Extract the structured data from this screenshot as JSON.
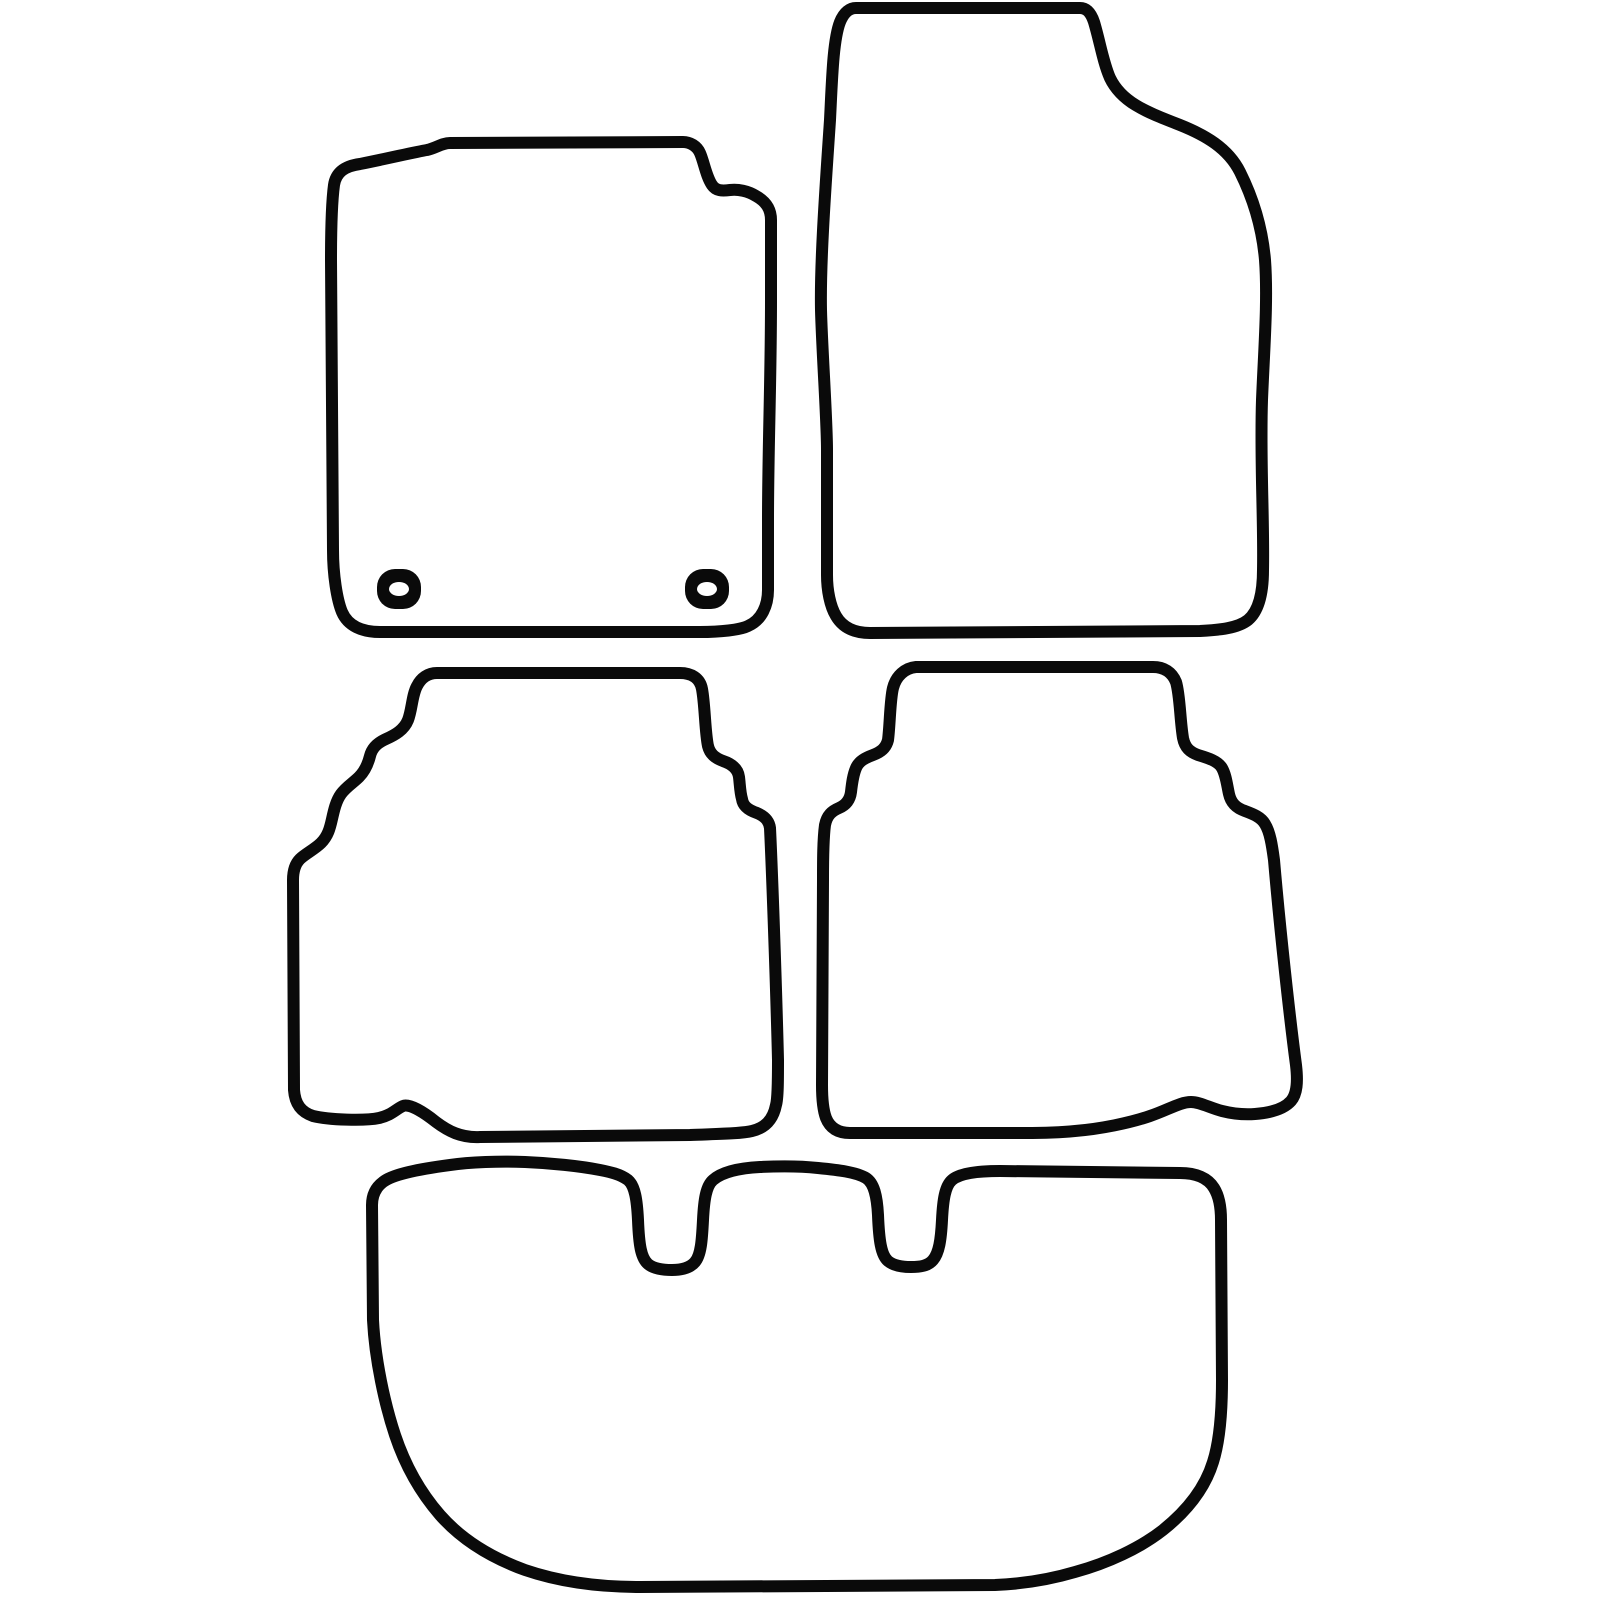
{
  "canvas": {
    "width": 1600,
    "height": 1600,
    "background_color": "#ffffff",
    "outline_color": "#0a0a0a",
    "outline_width": 12
  },
  "illustration": {
    "kind": "car-floor-mat-set-outline",
    "piece_count": 5
  },
  "mats": [
    {
      "id": "front-left-mat",
      "label": "front left mat",
      "d": "M 450,143 L 683,142 C 690,142 697,146 700,153 C 704,162 706,176 712,185 C 716,191 722,191 730,190 C 738,189 748,191 756,196 C 765,201 771,208 771,220 L 771,300 C 771,380 768,450 768,520 L 768,590 C 768,605 762,620 748,626 C 740,630 720,632 700,632 L 380,632 C 362,632 348,626 342,612 C 337,600 333,575 333,550 L 331,260 C 331,230 332,200 334,185 C 336,172 345,166 360,164 C 390,158 415,152 427,150 C 436,148 442,143 450,143 Z"
    },
    {
      "id": "front-right-mat",
      "label": "front right mat",
      "d": "M 856,8 L 1080,8 C 1087,8 1091,13 1094,22 C 1100,42 1103,62 1110,78 C 1122,103 1147,112 1180,125 C 1205,135 1228,148 1240,172 C 1252,196 1262,225 1265,260 C 1268,300 1264,350 1262,400 C 1260,460 1264,520 1263,570 C 1263,590 1260,610 1248,620 C 1238,628 1220,630 1200,631 L 870,633 C 855,633 843,628 836,616 C 830,606 827,590 827,575 L 827,450 C 827,420 822,350 821,310 C 820,260 826,180 830,120 C 832,80 833,40 840,22 C 844,12 850,8 856,8 Z"
    },
    {
      "id": "rear-left-mat",
      "label": "rear left mat",
      "d": "M 437,673 L 680,673 C 691,673 700,678 702,689 C 705,705 705,732 708,746 C 710,754 715,758 723,761 C 732,764 738,769 739,777 C 740,785 740,792 742,799 C 743,806 748,810 757,813 C 764,816 769,820 770,828 C 772,870 776,980 778,1060 C 778,1080 778,1098 776,1105 C 773,1120 765,1128 752,1131 C 740,1134 710,1134 690,1135 L 480,1137 C 461,1138 448,1131 436,1122 C 426,1114 410,1103 403,1106 C 396,1109 392,1115 379,1118 C 365,1121 329,1120 313,1116 C 301,1112 295,1104 294,1090 L 293,880 C 293,871 295,864 300,859 C 305,854 315,849 321,843 C 328,836 330,828 332,819 C 334,810 336,801 341,794 C 346,787 353,783 359,777 C 365,771 368,764 370,756 C 372,748 377,743 386,739 C 395,735 404,730 408,720 C 412,710 412,695 417,686 C 421,678 428,673 437,673 Z"
    },
    {
      "id": "rear-right-mat",
      "label": "rear right mat",
      "d": "M 930,667 L 1153,667 C 1164,667 1172,672 1176,682 C 1180,695 1180,720 1183,738 C 1185,748 1190,752 1198,755 C 1208,758 1218,761 1222,768 C 1226,775 1227,785 1229,794 C 1231,803 1236,808 1245,811 C 1253,814 1261,817 1265,824 C 1270,832 1272,845 1274,860 C 1280,930 1290,1020 1296,1065 C 1298,1082 1297,1094 1291,1101 C 1283,1110 1268,1113 1255,1114 C 1243,1115 1230,1113 1222,1111 C 1210,1108 1200,1102 1191,1102 C 1180,1102 1168,1110 1150,1116 C 1130,1123 1100,1129 1075,1131 C 1055,1133 1040,1133 1025,1133 L 850,1133 C 838,1133 830,1128 826,1118 C 823,1110 822,1098 822,1085 L 823,880 C 823,860 823,840 825,825 C 827,815 832,811 839,808 C 846,805 850,800 851,792 C 852,783 853,775 856,768 C 859,761 865,758 873,755 C 881,752 886,748 888,740 C 890,725 890,700 893,688 C 896,676 905,668 916,667 C 921,667 925,667 930,667 Z"
    },
    {
      "id": "boot-mat",
      "label": "rear boot mat",
      "d": "M 372,1205 C 372,1196 375,1188 383,1182 C 393,1174 420,1169 450,1165 C 470,1162 500,1161 525,1162 C 550,1163 580,1166 600,1170 C 610,1172 620,1174 628,1180 C 635,1186 637,1200 638,1220 C 639,1245 641,1258 648,1264 C 654,1269 664,1270 672,1270 C 682,1270 690,1268 695,1262 C 701,1255 702,1240 703,1220 C 704,1200 706,1186 713,1180 C 722,1172 740,1168 760,1167 C 780,1166 800,1166 818,1168 C 838,1170 856,1172 866,1178 C 874,1183 877,1196 878,1215 C 879,1240 881,1255 888,1261 C 894,1266 903,1267 911,1267 C 920,1267 928,1266 933,1260 C 939,1253 941,1240 942,1220 C 943,1200 945,1186 952,1180 C 960,1173 980,1171 1000,1171 L 1180,1173 C 1196,1173 1208,1178 1214,1188 C 1219,1196 1221,1208 1221,1220 L 1222,1380 C 1222,1410 1220,1440 1213,1462 C 1205,1488 1188,1510 1163,1530 C 1140,1548 1108,1563 1075,1572 C 1048,1580 1020,1584 995,1585 L 640,1587 C 600,1587 560,1582 525,1570 C 492,1558 462,1540 440,1515 C 420,1492 405,1465 395,1435 C 385,1405 375,1360 373,1320 L 372,1205 Z"
    }
  ],
  "eyelets": [
    {
      "id": "front-left-mat-eyelet-left",
      "x": 377,
      "y": 569,
      "w": 44,
      "h": 40,
      "hole_cx": 399,
      "hole_cy": 589,
      "hole_rx": 10,
      "hole_ry": 7
    },
    {
      "id": "front-left-mat-eyelet-right",
      "x": 685,
      "y": 569,
      "w": 44,
      "h": 40,
      "hole_cx": 707,
      "hole_cy": 589,
      "hole_rx": 10,
      "hole_ry": 7
    }
  ]
}
